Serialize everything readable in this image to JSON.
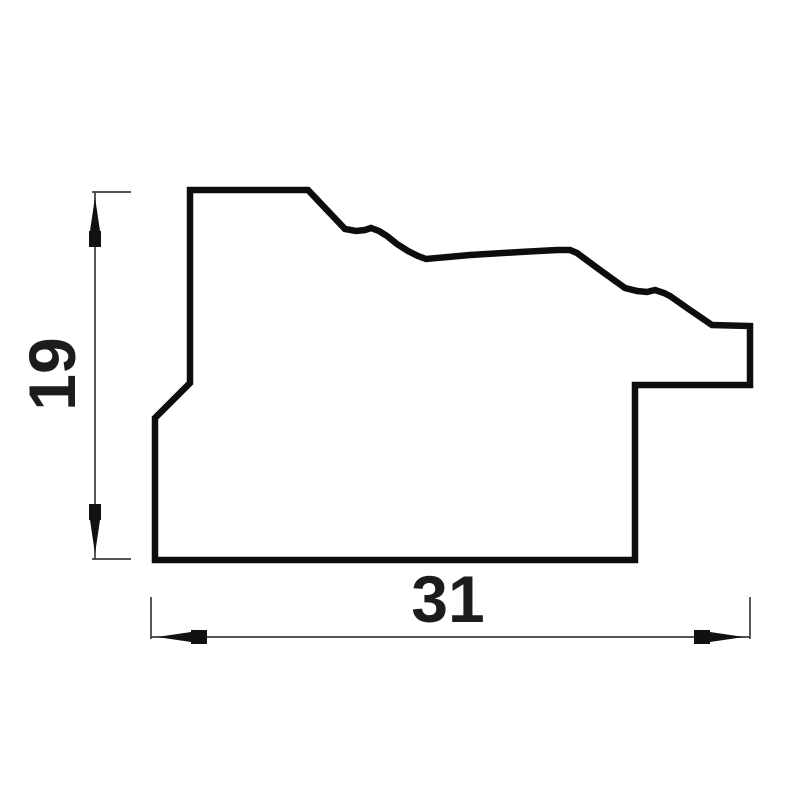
{
  "drawing": {
    "kind": "moulding-profile-cross-section",
    "background": "#ffffff",
    "outline_color": "#0d0d0d",
    "outline_width": 6.5,
    "dim_line_color": "#3c3c3c",
    "dim_line_width": 1.7,
    "arrow_color": "#111111",
    "text_color": "#1c1c1c",
    "profile_points": [
      [
        190,
        190
      ],
      [
        308,
        190
      ],
      [
        345,
        229
      ],
      [
        356,
        231
      ],
      [
        365,
        230
      ],
      [
        371,
        228
      ],
      [
        379,
        231
      ],
      [
        387,
        236
      ],
      [
        397,
        244
      ],
      [
        408,
        251
      ],
      [
        418,
        256
      ],
      [
        426,
        259
      ],
      [
        470,
        255
      ],
      [
        520,
        252
      ],
      [
        557,
        250
      ],
      [
        570,
        250
      ],
      [
        577,
        253
      ],
      [
        600,
        270
      ],
      [
        625,
        288
      ],
      [
        637,
        291
      ],
      [
        647,
        292
      ],
      [
        655,
        290
      ],
      [
        664,
        293
      ],
      [
        670,
        296
      ],
      [
        690,
        310
      ],
      [
        712,
        325
      ],
      [
        750,
        326
      ],
      [
        750,
        385
      ],
      [
        635,
        385
      ],
      [
        635,
        560
      ],
      [
        155,
        560
      ],
      [
        155,
        418
      ],
      [
        190,
        383
      ]
    ],
    "lines": [
      {
        "name": "height-extension-top",
        "x1": 92,
        "y1": 192,
        "x2": 131,
        "y2": 192
      },
      {
        "name": "height-extension-bottom",
        "x1": 92,
        "y1": 559,
        "x2": 131,
        "y2": 559
      },
      {
        "name": "height-dim-line",
        "x1": 95,
        "y1": 192,
        "x2": 95,
        "y2": 559
      },
      {
        "name": "width-extension-left",
        "x1": 151,
        "y1": 597,
        "x2": 151,
        "y2": 639
      },
      {
        "name": "width-extension-right",
        "x1": 750,
        "y1": 597,
        "x2": 750,
        "y2": 639
      },
      {
        "name": "width-dim-line",
        "x1": 151,
        "y1": 637,
        "x2": 750,
        "y2": 637
      }
    ],
    "arrows": [
      {
        "name": "height-arrow-up-icon",
        "points": [
          [
            95,
            197
          ],
          [
            100,
            231
          ],
          [
            101,
            231
          ],
          [
            101,
            247
          ],
          [
            89,
            247
          ],
          [
            89,
            231
          ],
          [
            90,
            231
          ]
        ]
      },
      {
        "name": "height-arrow-down-icon",
        "points": [
          [
            95,
            554
          ],
          [
            100,
            520
          ],
          [
            101,
            520
          ],
          [
            101,
            504
          ],
          [
            89,
            504
          ],
          [
            89,
            520
          ],
          [
            90,
            520
          ]
        ]
      },
      {
        "name": "width-arrow-left-icon",
        "points": [
          [
            157,
            637
          ],
          [
            191,
            632
          ],
          [
            191,
            630
          ],
          [
            207,
            630
          ],
          [
            207,
            644
          ],
          [
            191,
            644
          ],
          [
            191,
            642
          ]
        ]
      },
      {
        "name": "width-arrow-right-icon",
        "points": [
          [
            744,
            637
          ],
          [
            710,
            642
          ],
          [
            710,
            644
          ],
          [
            694,
            644
          ],
          [
            694,
            630
          ],
          [
            710,
            630
          ],
          [
            710,
            632
          ]
        ]
      }
    ],
    "dimensions": {
      "height": {
        "label": "19",
        "x": 75,
        "y": 374,
        "rotation": -90,
        "font_size": 66
      },
      "width": {
        "label": "31",
        "x": 448,
        "y": 622,
        "rotation": 0,
        "font_size": 66
      }
    }
  }
}
